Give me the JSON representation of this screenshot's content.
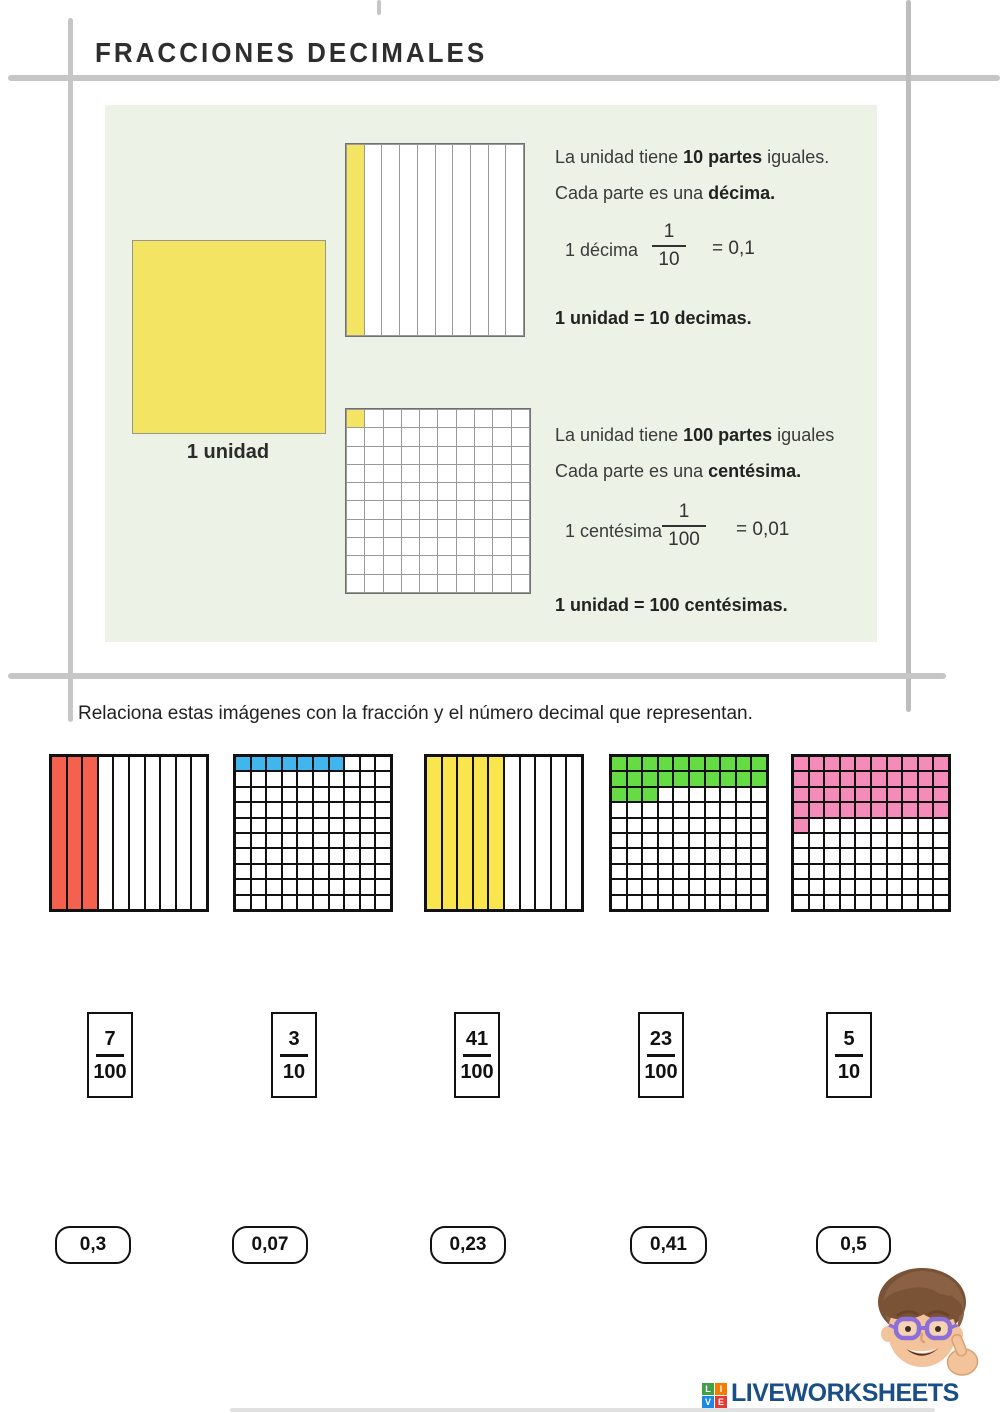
{
  "page": {
    "title": "FRACCIONES DECIMALES",
    "instruction": "Relaciona estas imágenes con la fracción y el número decimal que representan."
  },
  "explainer": {
    "unit_label": "1 unidad",
    "tenths_grid": {
      "type": "tenths",
      "shaded": 1,
      "color": "#f3e464"
    },
    "hundredths_grid": {
      "type": "hundredths",
      "shaded": 1,
      "color": "#f3e464"
    },
    "tenths": {
      "line1_pre": "La unidad tiene ",
      "line1_bold": "10 partes",
      "line1_post": " iguales.",
      "line2_pre": "Cada parte es una ",
      "line2_bold": "décima.",
      "fraction_label": "1 décima",
      "numerator": "1",
      "denominator": "10",
      "equals": "= 0,1",
      "summary": "1 unidad = 10 decimas."
    },
    "hundredths": {
      "line1_pre": "La unidad tiene ",
      "line1_bold": "100 partes",
      "line1_post": " iguales",
      "line2_pre": "Cada parte es una ",
      "line2_bold": "centésima.",
      "fraction_label": "1 centésima",
      "numerator": "1",
      "denominator": "100",
      "equals": "= 0,01",
      "summary": "1 unidad = 100 centésimas."
    }
  },
  "matching": {
    "grids": [
      {
        "type": "tenths",
        "shaded": 3,
        "color": "#f4614e"
      },
      {
        "type": "hundredths",
        "shaded": 7,
        "color": "#41b6ec"
      },
      {
        "type": "tenths",
        "shaded": 5,
        "color": "#f9e54e"
      },
      {
        "type": "hundredths",
        "shaded": 23,
        "color": "#65dc44"
      },
      {
        "type": "hundredths",
        "shaded": 41,
        "color": "#f58bb9"
      }
    ],
    "fractions": [
      {
        "numerator": "7",
        "denominator": "100"
      },
      {
        "numerator": "3",
        "denominator": "10"
      },
      {
        "numerator": "41",
        "denominator": "100"
      },
      {
        "numerator": "23",
        "denominator": "100"
      },
      {
        "numerator": "5",
        "denominator": "10"
      }
    ],
    "decimals": [
      "0,3",
      "0,07",
      "0,23",
      "0,41",
      "0,5"
    ]
  },
  "footer": {
    "logo_text": "LIVEWORKSHEETS",
    "logo_color": "#1a4e87",
    "logo_tiles": [
      {
        "letter": "L",
        "color": "#43a047"
      },
      {
        "letter": "I",
        "color": "#f57c00"
      },
      {
        "letter": "V",
        "color": "#1e88e5"
      },
      {
        "letter": "E",
        "color": "#e53935"
      }
    ]
  }
}
